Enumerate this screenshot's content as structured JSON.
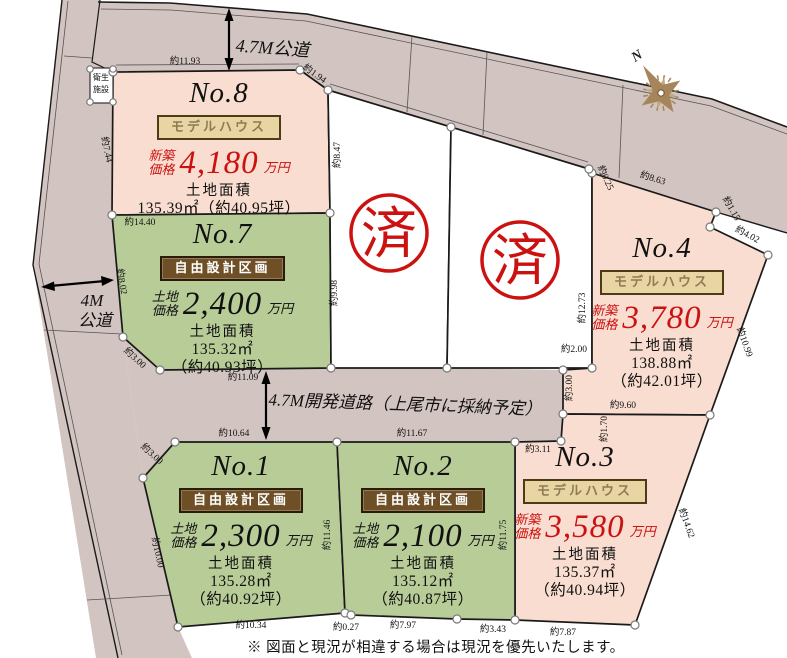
{
  "roads": {
    "top": "4.7M公道",
    "left_1": "4M",
    "left_2": "公道",
    "middle": "4.7M開発道路（上尾市に採納予定）"
  },
  "facility": {
    "line1": "衛生",
    "line2": "施設"
  },
  "stamp": {
    "text": "済"
  },
  "compass": {
    "label": "N"
  },
  "note": "※ 図面と現況が相違する場合は現況を優先いたします。",
  "plots": {
    "no8": {
      "name": "No.8",
      "badge": "モデルハウス",
      "price_label_1": "新築",
      "price_label_2": "価格",
      "price": "4,180",
      "unit": "万円",
      "area_label": "土地面積",
      "area_1": "135.39㎡（約40.95坪）"
    },
    "no7": {
      "name": "No.7",
      "badge": "自由設計区画",
      "price_label_1": "土地",
      "price_label_2": "価格",
      "price": "2,400",
      "unit": "万円",
      "area_label": "土地面積",
      "area_1": "135.32㎡",
      "area_2": "（約40.93坪）"
    },
    "no4": {
      "name": "No.4",
      "badge": "モデルハウス",
      "price_label_1": "新築",
      "price_label_2": "価格",
      "price": "3,780",
      "unit": "万円",
      "area_label": "土地面積",
      "area_1": "138.88㎡",
      "area_2": "（約42.01坪）"
    },
    "no1": {
      "name": "No.1",
      "badge": "自由設計区画",
      "price_label_1": "土地",
      "price_label_2": "価格",
      "price": "2,300",
      "unit": "万円",
      "area_label": "土地面積",
      "area_1": "135.28㎡",
      "area_2": "（約40.92坪）"
    },
    "no2": {
      "name": "No.2",
      "badge": "自由設計区画",
      "price_label_1": "土地",
      "price_label_2": "価格",
      "price": "2,100",
      "unit": "万円",
      "area_label": "土地面積",
      "area_1": "135.12㎡",
      "area_2": "（約40.87坪）"
    },
    "no3": {
      "name": "No.3",
      "badge": "モデルハウス",
      "price_label_1": "新築",
      "price_label_2": "価格",
      "price": "3,580",
      "unit": "万円",
      "area_label": "土地面積",
      "area_1": "135.37㎡",
      "area_2": "（約40.94坪）"
    }
  },
  "dims": {
    "no8_top": "約11.93",
    "no8_jog": "約1.94",
    "no8_right": "約8.47",
    "no8_left": "約7.44",
    "no7_top": "約14.40",
    "no7_left": "約8.02",
    "no7_right": "約9.98",
    "no7_diag": "約3.00",
    "no7_bottom": "約11.09",
    "sold_right": "約12.73",
    "no4_jog": "約2.00",
    "no4_notch": "約3.00",
    "no4_corner": "約0.25",
    "no4_top": "約8.63",
    "no4_cut1": "約1.15",
    "no4_cut2": "約4.02",
    "no4_right": "約10.99",
    "no4_bottom": "約9.60",
    "no3_top_left": "約1.70",
    "road_end": "約3.11",
    "no3_right": "約14.62",
    "no3_bottom": "約7.87",
    "no2_bottom_2": "約3.43",
    "no2_bottom_1": "約7.97",
    "jog_1_2": "約0.27",
    "no1_bottom": "約10.34",
    "no1_left": "約10.00",
    "no1_diag": "約3.00",
    "no1_top": "約10.64",
    "no2_top": "約11.67",
    "no1_right": "約11.46",
    "no2_right": "約11.75"
  },
  "colors": {
    "road": "#d2c4c0",
    "model_plot": "#f8ddd0",
    "free_plot": "#b8cc98",
    "accent_red": "#cc1111"
  }
}
